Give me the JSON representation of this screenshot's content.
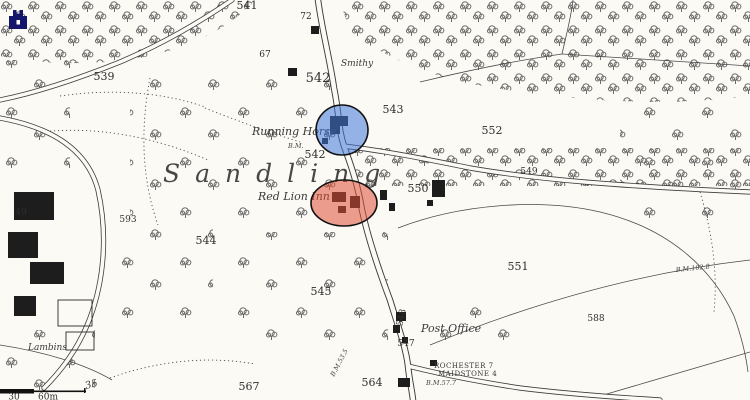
{
  "map": {
    "place_name": "Sandling",
    "parcels": {
      "p49": "49",
      "p67": "67",
      "p72": "72",
      "p539": "539",
      "p541": "541",
      "p542_top": "542",
      "p542_mid": "542",
      "p543": "543",
      "p544": "544",
      "p545": "545",
      "p547": "547",
      "p548": "548",
      "p549": "549",
      "p550": "550",
      "p551": "551",
      "p552": "552",
      "p564": "564",
      "p567": "567",
      "p588": "588",
      "p593": "593"
    },
    "names": {
      "running_horse": "Running Horse",
      "red_lion": "Red Lion Inn",
      "smithy": "Smithy",
      "post_office": "Post Office",
      "field_house": "Lambins"
    },
    "milestone": {
      "line1": "ROCHESTER 7",
      "line2": "MAIDSTONE 4",
      "benchmark": "B.M.57.7"
    },
    "benchmarks": {
      "road_bm": "B.M.",
      "south_bm": "B.M.53.5",
      "east_bm": "B.M.102.8"
    },
    "contour_label": "35",
    "scale_bar": {
      "left_label": "30",
      "right_label": "60m"
    },
    "highlights": {
      "blue_area": {
        "color": "#3f76d8"
      },
      "red_area": {
        "color": "#e04f35"
      }
    },
    "controls": {
      "home_icon_color": "#15156b"
    }
  }
}
